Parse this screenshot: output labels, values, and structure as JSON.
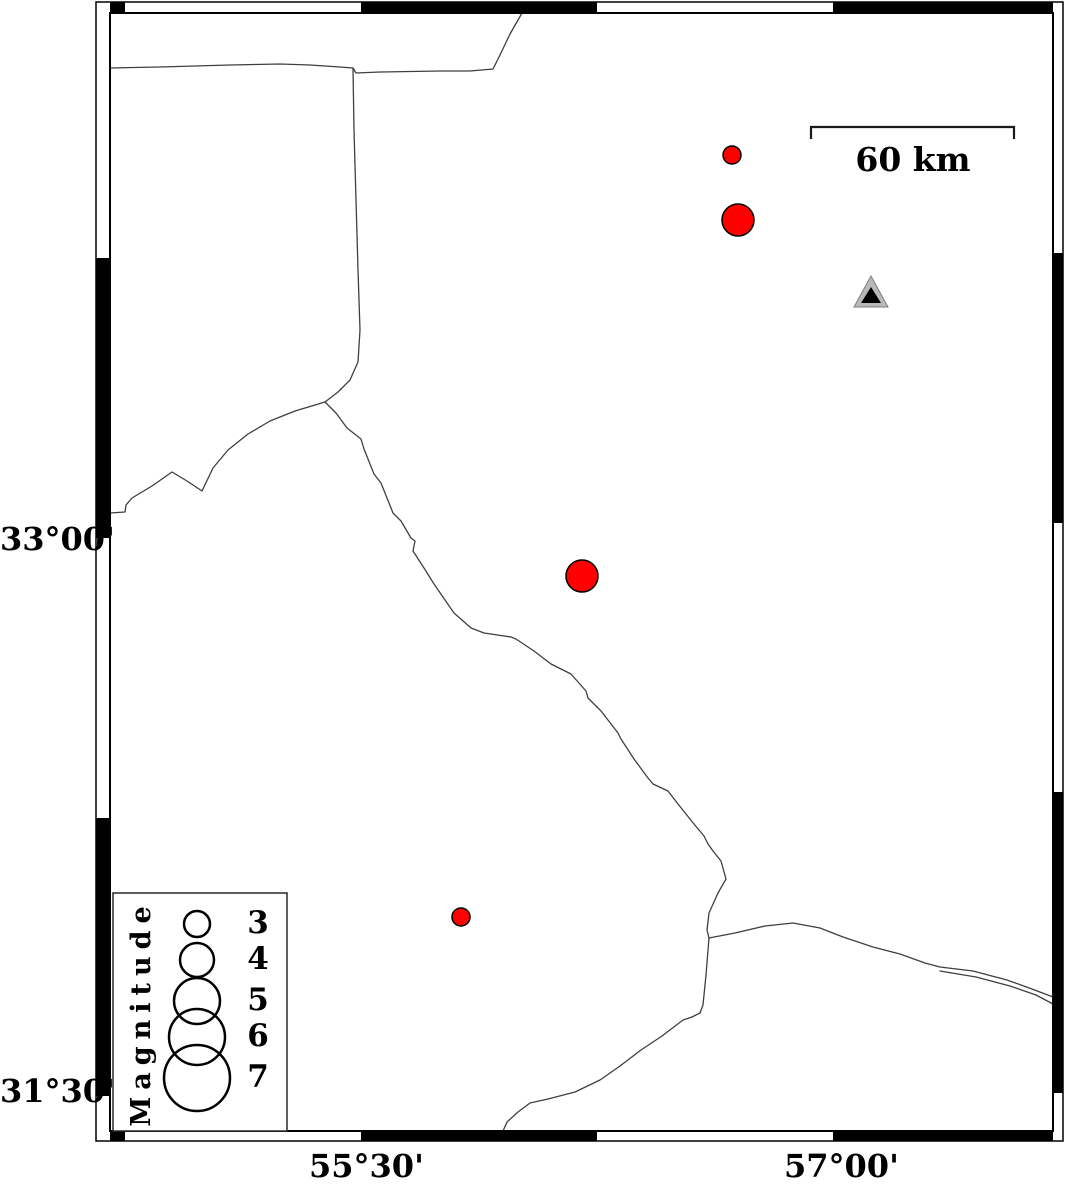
{
  "map": {
    "width": 1066,
    "height": 1180,
    "colors": {
      "background": "#ffffff",
      "earthquake_fill": "#fe0000",
      "marker_outline": "#000000",
      "boundary_line": "#3f3f3f",
      "station_fill": "#b9b9b9",
      "station_edge": "#7d7d7d",
      "station_inner": "#000000",
      "frame": "#000000"
    },
    "axis": {
      "left_labels": [
        {
          "text": "33°00'",
          "y": 538
        },
        {
          "text": "31°30'",
          "y": 1090
        }
      ],
      "bottom_labels": [
        {
          "text": "55°30'",
          "x": 359
        },
        {
          "text": "57°00'",
          "x": 834
        }
      ]
    },
    "frame": {
      "outer": {
        "x": 96,
        "y": 2,
        "w": 967,
        "h": 1139
      },
      "inner": {
        "x": 110,
        "y": 13,
        "w": 943,
        "h": 1118
      },
      "top_black": [
        [
          110,
          125
        ],
        [
          361,
          597
        ],
        [
          833,
          1053
        ]
      ],
      "bottom_black": [
        [
          110,
          125
        ],
        [
          361,
          597
        ],
        [
          833,
          1053
        ]
      ],
      "left_black": [
        [
          258,
          538
        ],
        [
          818,
          1096
        ]
      ],
      "right_black": [
        [
          253,
          523
        ],
        [
          792,
          1093
        ]
      ]
    },
    "scalebar": {
      "label": "60 km",
      "x1": 811,
      "x2": 1014,
      "y": 127,
      "tick_len": 12
    },
    "station": {
      "outer": [
        [
          871,
          276
        ],
        [
          854,
          307
        ],
        [
          888,
          307
        ]
      ],
      "inner": [
        [
          871,
          287
        ],
        [
          861,
          303
        ],
        [
          881,
          303
        ]
      ]
    },
    "earthquakes": [
      {
        "x": 732,
        "y": 155,
        "r": 9
      },
      {
        "x": 738,
        "y": 220,
        "r": 16
      },
      {
        "x": 582,
        "y": 576,
        "r": 16
      },
      {
        "x": 461,
        "y": 917,
        "r": 9
      }
    ],
    "legend": {
      "title": "Magnitude",
      "box": {
        "x": 113,
        "y": 893,
        "w": 174,
        "h": 238
      },
      "circle_cx": 197,
      "entries": [
        {
          "magnitude": "3",
          "cy": 924,
          "r": 13
        },
        {
          "magnitude": "4",
          "cy": 960,
          "r": 17
        },
        {
          "magnitude": "5",
          "cy": 1001,
          "r": 23
        },
        {
          "magnitude": "6",
          "cy": 1037,
          "r": 28
        },
        {
          "magnitude": "7",
          "cy": 1078,
          "r": 33
        }
      ]
    },
    "boundaries": [
      {
        "id": "north-west",
        "points": [
          [
            110,
            68
          ],
          [
            160,
            67
          ],
          [
            230,
            65
          ],
          [
            280,
            64
          ],
          [
            310,
            65
          ],
          [
            340,
            67
          ],
          [
            353,
            68
          ]
        ]
      },
      {
        "id": "north-east",
        "points": [
          [
            353,
            68
          ],
          [
            356,
            73
          ],
          [
            380,
            72
          ],
          [
            440,
            71
          ],
          [
            470,
            71
          ],
          [
            493,
            69
          ],
          [
            500,
            55
          ],
          [
            510,
            34
          ],
          [
            522,
            13
          ]
        ]
      },
      {
        "id": "west-branch",
        "points": [
          [
            353,
            68
          ],
          [
            354,
            130
          ],
          [
            356,
            200
          ],
          [
            358,
            270
          ],
          [
            360,
            330
          ],
          [
            358,
            362
          ],
          [
            350,
            380
          ],
          [
            338,
            392
          ],
          [
            325,
            402
          ]
        ]
      },
      {
        "id": "southwest-branch",
        "points": [
          [
            325,
            402
          ],
          [
            295,
            411
          ],
          [
            270,
            421
          ],
          [
            248,
            434
          ],
          [
            228,
            450
          ],
          [
            213,
            468
          ],
          [
            202,
            491
          ],
          [
            187,
            481
          ],
          [
            172,
            472
          ],
          [
            152,
            486
          ],
          [
            132,
            498
          ],
          [
            126,
            505
          ],
          [
            125,
            512
          ],
          [
            110,
            513
          ]
        ]
      },
      {
        "id": "central-diagonal",
        "points": [
          [
            325,
            402
          ],
          [
            336,
            413
          ],
          [
            347,
            428
          ],
          [
            361,
            439
          ],
          [
            364,
            449
          ],
          [
            374,
            474
          ],
          [
            381,
            483
          ],
          [
            393,
            513
          ],
          [
            401,
            521
          ],
          [
            411,
            538
          ],
          [
            415,
            541
          ],
          [
            413,
            551
          ],
          [
            424,
            568
          ],
          [
            434,
            584
          ],
          [
            454,
            613
          ],
          [
            471,
            628
          ],
          [
            484,
            633
          ],
          [
            511,
            637
          ],
          [
            516,
            639
          ],
          [
            534,
            651
          ],
          [
            551,
            664
          ],
          [
            571,
            674
          ],
          [
            586,
            691
          ],
          [
            588,
            698
          ],
          [
            601,
            711
          ],
          [
            618,
            733
          ],
          [
            621,
            739
          ],
          [
            634,
            759
          ],
          [
            648,
            778
          ],
          [
            653,
            784
          ],
          [
            668,
            791
          ],
          [
            678,
            804
          ],
          [
            694,
            824
          ],
          [
            704,
            836
          ],
          [
            708,
            844
          ],
          [
            713,
            851
          ],
          [
            721,
            861
          ],
          [
            726,
            879
          ],
          [
            718,
            893
          ],
          [
            709,
            913
          ],
          [
            707,
            930
          ],
          [
            709,
            938
          ]
        ]
      },
      {
        "id": "southeast-upper",
        "points": [
          [
            709,
            938
          ],
          [
            735,
            933
          ],
          [
            765,
            926
          ],
          [
            793,
            923
          ],
          [
            820,
            928
          ],
          [
            843,
            937
          ],
          [
            873,
            947
          ],
          [
            900,
            954
          ],
          [
            925,
            963
          ],
          [
            940,
            967
          ],
          [
            973,
            971
          ],
          [
            1007,
            980
          ],
          [
            1032,
            989
          ],
          [
            1053,
            997
          ]
        ]
      },
      {
        "id": "southeast-lower",
        "points": [
          [
            940,
            971
          ],
          [
            976,
            977
          ],
          [
            1010,
            986
          ],
          [
            1036,
            995
          ],
          [
            1053,
            1004
          ]
        ]
      },
      {
        "id": "south-to-bottom",
        "points": [
          [
            709,
            938
          ],
          [
            706,
            975
          ],
          [
            703,
            1005
          ],
          [
            700,
            1013
          ],
          [
            692,
            1017
          ],
          [
            683,
            1020
          ],
          [
            662,
            1036
          ],
          [
            641,
            1050
          ],
          [
            620,
            1066
          ],
          [
            600,
            1080
          ],
          [
            575,
            1092
          ],
          [
            548,
            1099
          ],
          [
            530,
            1103
          ],
          [
            518,
            1112
          ],
          [
            507,
            1122
          ],
          [
            503,
            1131
          ]
        ]
      }
    ]
  }
}
